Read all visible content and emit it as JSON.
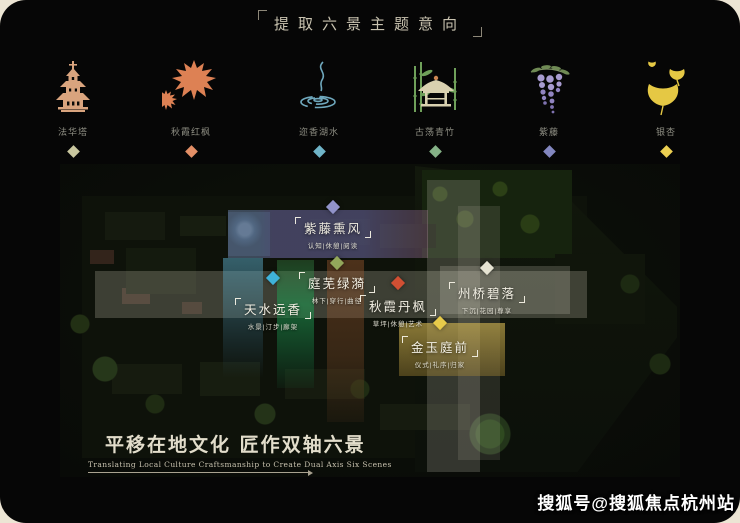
{
  "header": {
    "title": "提取六景主题意向"
  },
  "icons": [
    {
      "label": "法华塔",
      "icon": "pagoda-icon",
      "color": "#c9c79f"
    },
    {
      "label": "秋霞红枫",
      "icon": "maple-icon",
      "color": "#e38f66"
    },
    {
      "label": "迩香湖水",
      "icon": "ripple-icon",
      "color": "#6fb4c8"
    },
    {
      "label": "古荡青竹",
      "icon": "pavilion-bamboo-icon",
      "color": "#85b287"
    },
    {
      "label": "紫藤",
      "icon": "wisteria-icon",
      "color": "#8387bf"
    },
    {
      "label": "银杏",
      "icon": "ginkgo-icon",
      "color": "#ecd052"
    }
  ],
  "map": {
    "zones": [
      {
        "title": "紫藤熏风",
        "tags": "认知|休憩|阅读",
        "color": "#9193c9"
      },
      {
        "title": "天水远香",
        "tags": "水景|汀步|廊架",
        "color": "#3fb3da"
      },
      {
        "title": "庭芜绿漪",
        "tags": "林下|穿行|曲径",
        "color": "#93a75b"
      },
      {
        "title": "秋霞丹枫",
        "tags": "草坪|休憩|艺术",
        "color": "#d14f33"
      },
      {
        "title": "州桥碧落",
        "tags": "下沉|花园|尊享",
        "color": "#e6e3d2"
      },
      {
        "title": "金玉庭前",
        "tags": "仪式|礼序|归家",
        "color": "#e8cb4a"
      }
    ]
  },
  "caption": {
    "zh": "平移在地文化 匠作双轴六景",
    "en": "Translating Local Culture Craftsmanship to Create Dual Axis Six Scenes"
  },
  "watermark": {
    "text": "搜狐号@搜狐焦点杭州站"
  }
}
